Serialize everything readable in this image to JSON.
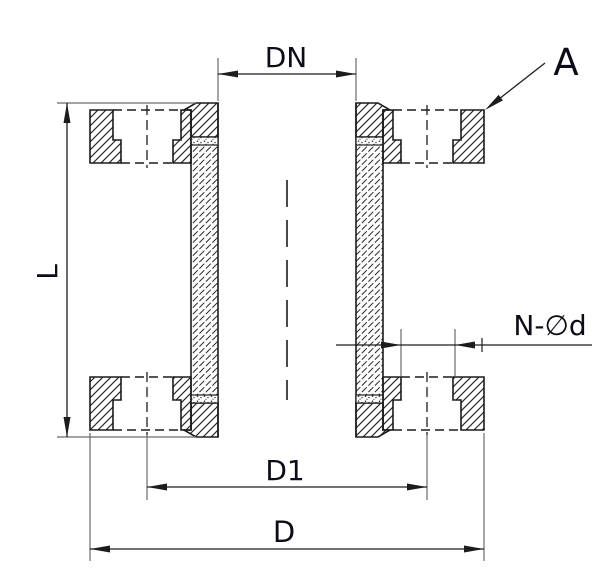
{
  "labels": {
    "nominal_diameter": "DN",
    "detail_marker": "A",
    "overall_length": "L",
    "bolt_holes": "N-∅d",
    "bolt_circle_diameter": "D1",
    "outer_diameter": "D"
  },
  "colors": {
    "background": "#ffffff",
    "outline": "#1c1c1c",
    "dimension_line": "#1c1c1c",
    "extension_line": "#6a6a6a",
    "label_text": "#0c0c18"
  }
}
